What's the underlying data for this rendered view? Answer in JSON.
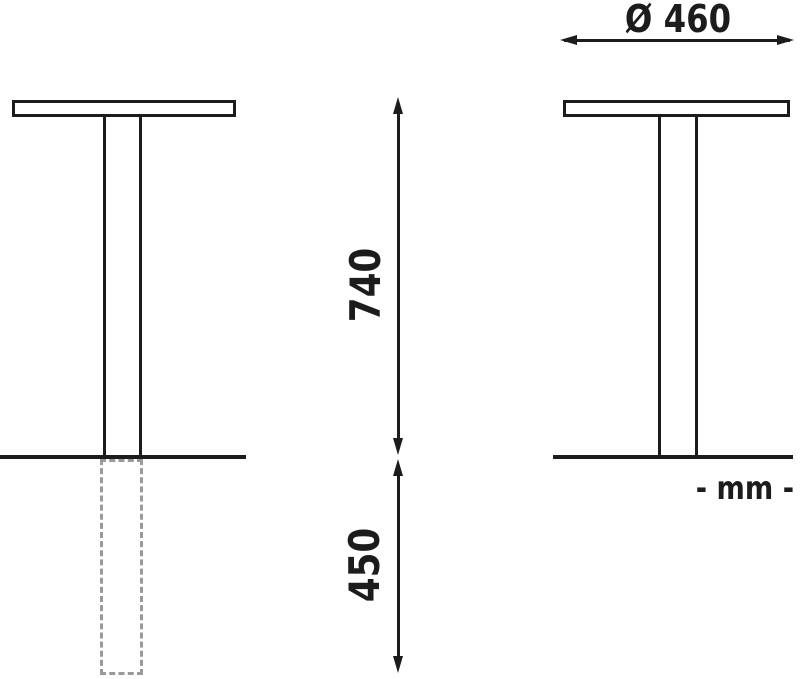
{
  "drawing": {
    "dimensions": {
      "diameter": "Ø 460",
      "height_above_ground": "740",
      "embed_depth": "450"
    },
    "unit_note": "- mm -",
    "colors": {
      "line": "#1c1c1c",
      "hidden_line": "#9a9a9a",
      "background": "#ffffff"
    }
  }
}
